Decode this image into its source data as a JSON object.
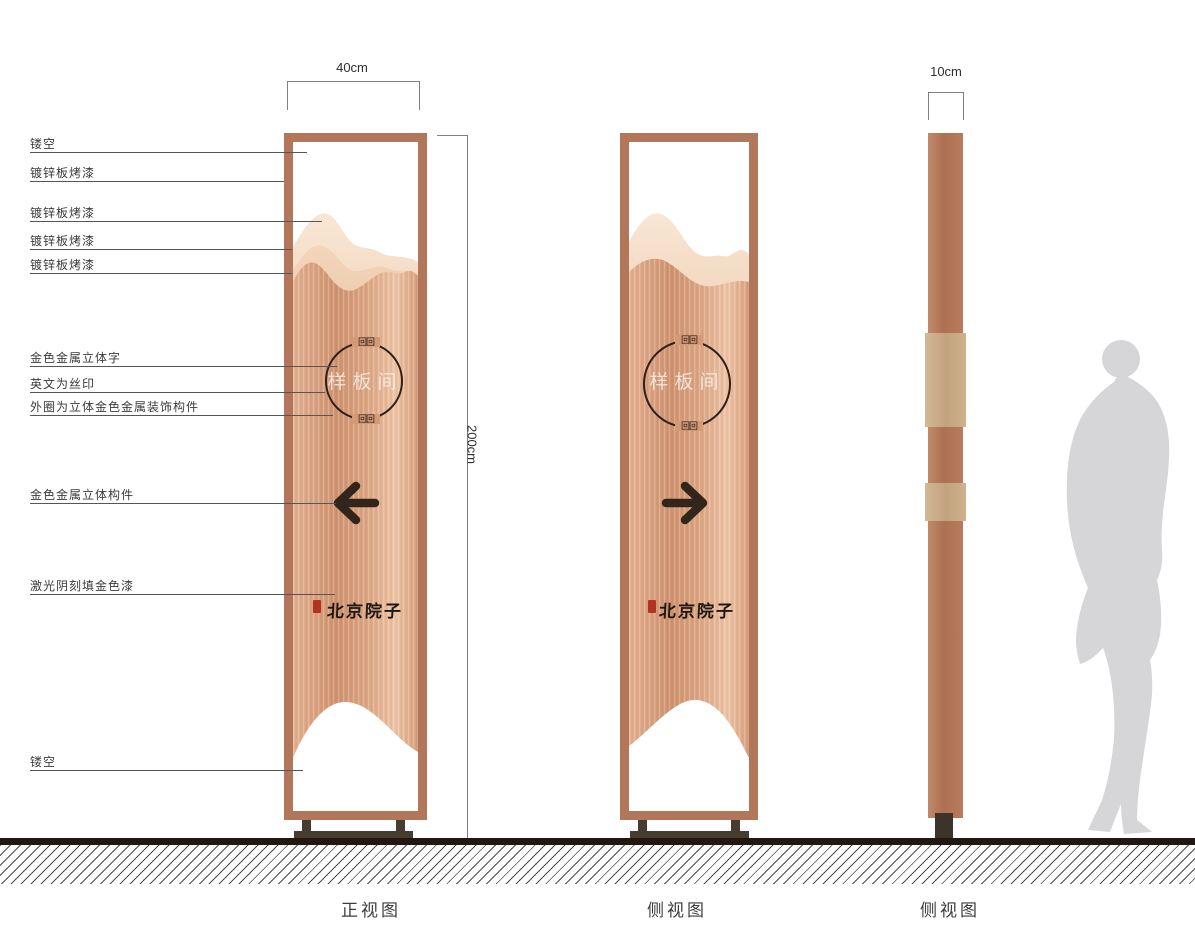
{
  "callouts": [
    {
      "label": "镂空"
    },
    {
      "label": "镀锌板烤漆"
    },
    {
      "label": "镀锌板烤漆"
    },
    {
      "label": "镀锌板烤漆"
    },
    {
      "label": "镀锌板烤漆"
    },
    {
      "label": "金色金属立体字"
    },
    {
      "label": "英文为丝印"
    },
    {
      "label": "外圈为立体金色金属装饰构件"
    },
    {
      "label": "金色金属立体构件"
    },
    {
      "label": "激光阴刻填金色漆"
    },
    {
      "label": "镂空"
    }
  ],
  "dimensions": {
    "front_width": "40cm",
    "total_height": "200cm",
    "side_depth": "10cm"
  },
  "views": [
    {
      "label": "正视图"
    },
    {
      "label": "侧视图"
    },
    {
      "label": "侧视图"
    }
  ],
  "sign": {
    "room_name": "样板间",
    "english_subtext": "· · · · · · · ·",
    "brand_calligraphy": "北京院子",
    "ornament_glyph": "回回"
  },
  "colors": {
    "copper_frame": "#b2775a",
    "copper_body": "#d79d7b",
    "mountain_light": "#f6e0cb",
    "mountain_mid": "#efccae",
    "mountain_front": "#e5bb9b",
    "base_dark": "#463c2f",
    "ground_black": "#221811",
    "seal_red": "#b13422",
    "silhouette_gray": "#d6d6d8",
    "ornament_dark": "#2c2018"
  }
}
